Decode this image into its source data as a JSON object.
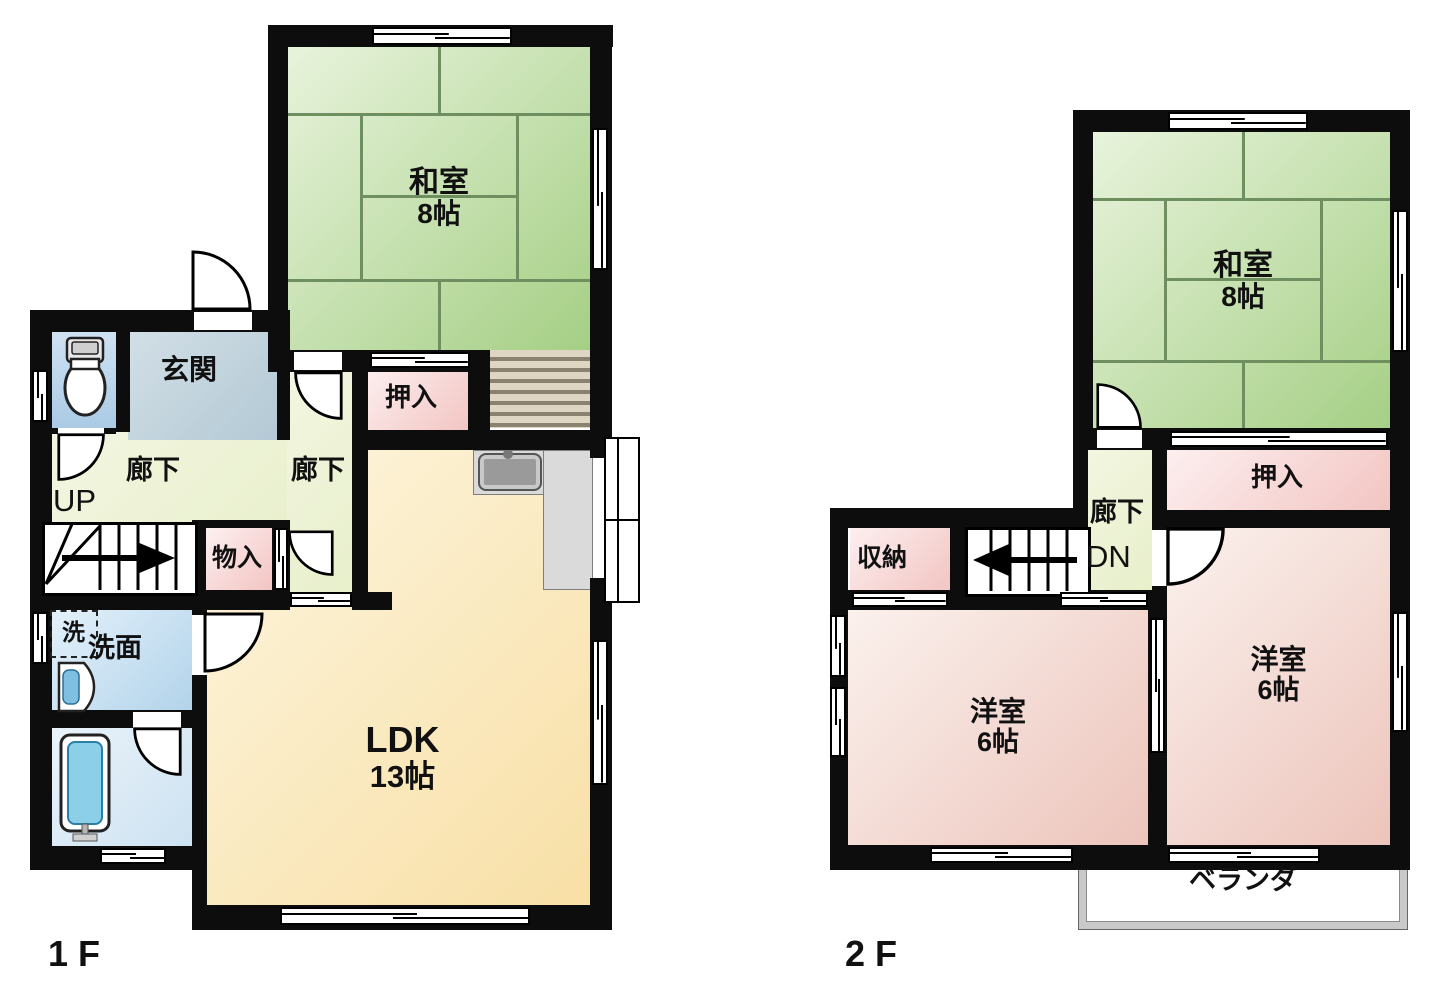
{
  "f1": {
    "label": "1 F",
    "washitsu_name": "和室",
    "washitsu_size": "8帖",
    "genkan": "玄関",
    "corridor_a": "廊下",
    "corridor_b": "廊下",
    "up": "UP",
    "oshiire": "押入",
    "monoire": "物入",
    "laundry": "洗",
    "senmen": "洗面",
    "ldk_name": "LDK",
    "ldk_size": "13帖"
  },
  "f2": {
    "label": "2 F",
    "washitsu_name": "和室",
    "washitsu_size": "8帖",
    "oshiire": "押入",
    "corridor": "廊下",
    "dn": "DN",
    "shuunou": "収納",
    "yl_name": "洋室",
    "yl_size": "6帖",
    "yr_name": "洋室",
    "yr_size": "6帖",
    "veranda": "ベランダ"
  },
  "colors": {
    "wall": "#0d0d0d",
    "tatami_green": "#a5cf85",
    "closet_pink": "#f2c5c2",
    "western_pink": "#ecc4bb",
    "ldk_cream": "#f8dfa5",
    "corridor_green": "#e7efca",
    "entry_bluegray": "#b3c9d5",
    "water_blue": "#b2d3ea"
  }
}
